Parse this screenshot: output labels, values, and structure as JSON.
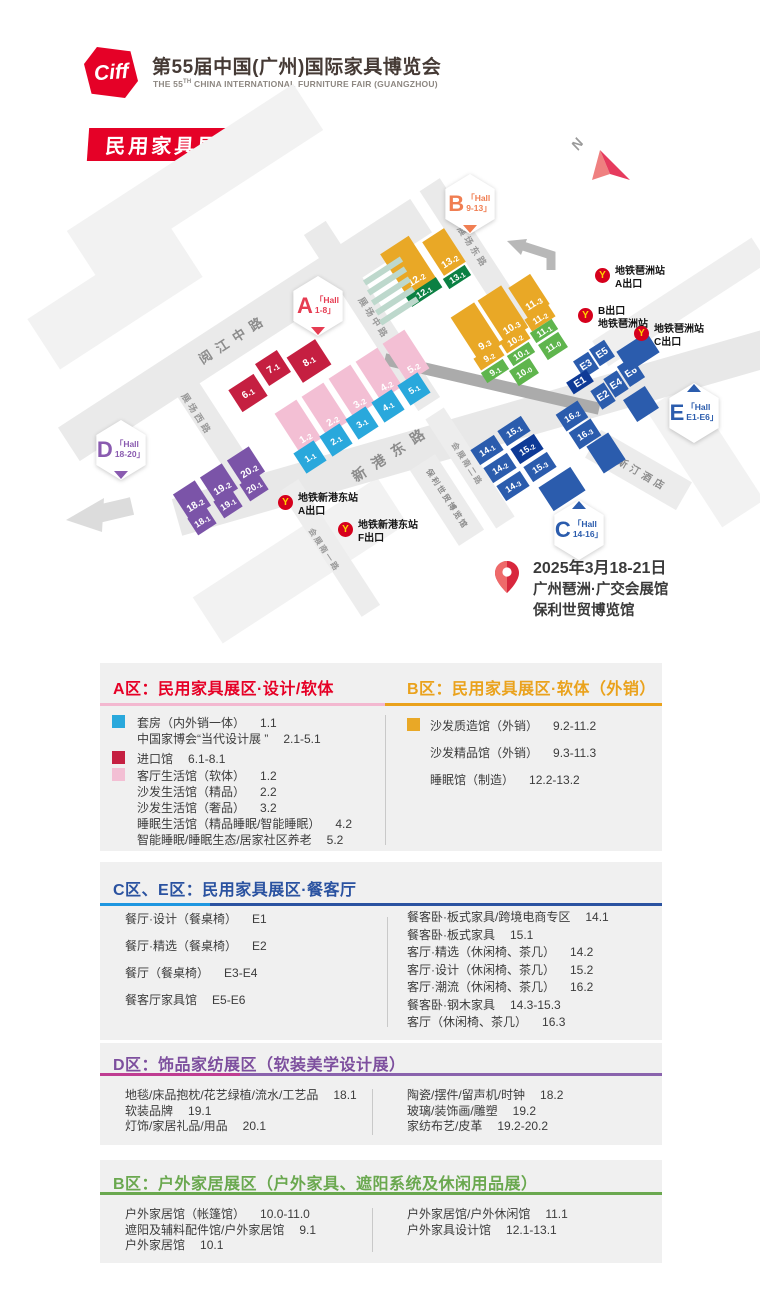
{
  "header": {
    "logo_text": "Ciff",
    "title": "第55届中国(广州)国际家具博览会",
    "subtitle_prefix": "THE 55",
    "subtitle_sup": "TH",
    "subtitle_rest": " CHINA INTERNATIONAL FURNITURE FAIR (GUANGZHOU)",
    "badge": "民用家具展"
  },
  "map": {
    "north_label": "N",
    "date": "2025年3月18-21日",
    "venue1": "广州琶洲·广交会展馆",
    "venue2": "保利世贸博览馆",
    "colors": {
      "red": "#c51f41",
      "pink": "#f3bfd4",
      "blue": "#29a8dc",
      "yellow": "#e9a826",
      "dgreen": "#0b8043",
      "green": "#5fb54d",
      "navy": "#2b5cad",
      "dnavy": "#0e3a96",
      "purple": "#7b54a8",
      "teal": "#bdd8cc"
    },
    "badges": [
      {
        "letter": "B",
        "hall": "Hall",
        "range": "9-13",
        "color": "#f07e52",
        "x": 470,
        "y": 204,
        "pointer": "down"
      },
      {
        "letter": "A",
        "hall": "Hall",
        "range": "1-8",
        "color": "#e63c52",
        "x": 318,
        "y": 306,
        "pointer": "down"
      },
      {
        "letter": "D",
        "hall": "Hall",
        "range": "18-20",
        "color": "#8a5bb0",
        "x": 121,
        "y": 450,
        "pointer": "down"
      },
      {
        "letter": "E",
        "hall": "Hall",
        "range": "E1-E6",
        "color": "#2b5cad",
        "x": 694,
        "y": 413,
        "pointer": "up"
      },
      {
        "letter": "C",
        "hall": "Hall",
        "range": "14-16",
        "color": "#2b5cad",
        "x": 579,
        "y": 530,
        "pointer": "up"
      }
    ],
    "metro": [
      {
        "lines": [
          "地铁琶洲站",
          "A出口"
        ],
        "x": 595,
        "y": 268
      },
      {
        "lines": [
          "B出口",
          "地铁琶洲站"
        ],
        "x": 578,
        "y": 308
      },
      {
        "lines": [
          "地铁琶洲站",
          "C出口"
        ],
        "x": 634,
        "y": 326
      },
      {
        "lines": [
          "地铁新港东站",
          "A出口"
        ],
        "x": 278,
        "y": 495
      },
      {
        "lines": [
          "地铁新港东站",
          "F出口"
        ],
        "x": 338,
        "y": 522
      }
    ],
    "roads": [
      {
        "x": 195,
        "y": 180,
        "w": 270,
        "h": 55,
        "rot": -33,
        "c": "#f2f2f2"
      },
      {
        "x": 115,
        "y": 298,
        "w": 170,
        "h": 60,
        "rot": -33,
        "c": "#f2f2f2"
      },
      {
        "x": 300,
        "y": 560,
        "w": 220,
        "h": 55,
        "rot": -33,
        "c": "#f2f2f2"
      },
      {
        "x": 680,
        "y": 302,
        "w": 190,
        "h": 30,
        "rot": -33,
        "c": "#efefef"
      },
      {
        "x": 705,
        "y": 455,
        "w": 140,
        "h": 50,
        "rot": 57,
        "c": "#f2f2f2"
      },
      {
        "x": 245,
        "y": 330,
        "w": 420,
        "h": 40,
        "rot": -33,
        "c": "#eaeaea"
      },
      {
        "x": 208,
        "y": 420,
        "w": 150,
        "h": 26,
        "rot": 57,
        "c": "#eaeaea"
      },
      {
        "x": 372,
        "y": 316,
        "w": 210,
        "h": 26,
        "rot": 57,
        "c": "#eaeaea"
      },
      {
        "x": 476,
        "y": 256,
        "w": 170,
        "h": 24,
        "rot": 57,
        "c": "#eaeaea"
      },
      {
        "x": 475,
        "y": 432,
        "w": 620,
        "h": 38,
        "rot": -16,
        "c": "#e8e8e8"
      },
      {
        "x": 330,
        "y": 548,
        "w": 150,
        "h": 22,
        "rot": 57,
        "c": "#ededed"
      },
      {
        "x": 470,
        "y": 468,
        "w": 130,
        "h": 22,
        "rot": 57,
        "c": "#ededed"
      },
      {
        "x": 638,
        "y": 470,
        "w": 105,
        "h": 32,
        "rot": 30,
        "c": "#ececec"
      },
      {
        "x": 447,
        "y": 500,
        "w": 90,
        "h": 30,
        "rot": 57,
        "c": "#ececec"
      },
      {
        "x": 492,
        "y": 384,
        "w": 220,
        "h": 12,
        "rot": 13,
        "c": "#ababab"
      }
    ],
    "road_labels": [
      {
        "text": "阅江中路",
        "x": 233,
        "y": 338,
        "rot": -33,
        "fs": 13,
        "ls": 7,
        "c": "#8c8c8c"
      },
      {
        "text": "展场中路",
        "x": 374,
        "y": 318,
        "rot": 57,
        "fs": 9,
        "ls": 3,
        "c": "#9a9a9a"
      },
      {
        "text": "展场东路",
        "x": 473,
        "y": 247,
        "rot": 57,
        "fs": 9,
        "ls": 3,
        "c": "#9a9a9a"
      },
      {
        "text": "展场西路",
        "x": 197,
        "y": 414,
        "rot": 57,
        "fs": 9,
        "ls": 3,
        "c": "#9a9a9a"
      },
      {
        "text": "新港东路",
        "x": 392,
        "y": 453,
        "rot": -33,
        "fs": 14,
        "ls": 9,
        "c": "#8c8c8c"
      },
      {
        "text": "会展南一路",
        "x": 324,
        "y": 550,
        "rot": 57,
        "fs": 8,
        "ls": 2,
        "c": "#9a9a9a"
      },
      {
        "text": "会展南二路",
        "x": 467,
        "y": 464,
        "rot": 57,
        "fs": 8,
        "ls": 2,
        "c": "#9a9a9a"
      },
      {
        "text": "威斯汀酒店",
        "x": 637,
        "y": 470,
        "rot": 30,
        "fs": 10,
        "ls": 4,
        "c": "#8c8c8c"
      },
      {
        "text": "保利世贸博览馆",
        "x": 447,
        "y": 499,
        "rot": 57,
        "fs": 8,
        "ls": 2,
        "c": "#8c8c8c"
      }
    ],
    "blocks": [
      {
        "t": "6.1",
        "x": 248,
        "y": 393,
        "w": 30,
        "h": 26,
        "c": "red"
      },
      {
        "t": "7.1",
        "x": 273,
        "y": 368,
        "w": 26,
        "h": 26,
        "c": "red"
      },
      {
        "t": "8.1",
        "x": 309,
        "y": 361,
        "w": 34,
        "h": 30,
        "c": "red"
      },
      {
        "t": "1.2",
        "x": 298,
        "y": 426,
        "w": 26,
        "h": 46,
        "c": "pink",
        "a": "end"
      },
      {
        "t": "2.2",
        "x": 325,
        "y": 409,
        "w": 26,
        "h": 46,
        "c": "pink",
        "a": "end"
      },
      {
        "t": "3.2",
        "x": 352,
        "y": 391,
        "w": 26,
        "h": 46,
        "c": "pink",
        "a": "end"
      },
      {
        "t": "4.2",
        "x": 379,
        "y": 374,
        "w": 26,
        "h": 46,
        "c": "pink",
        "a": "end"
      },
      {
        "t": "5.2",
        "x": 406,
        "y": 356,
        "w": 26,
        "h": 46,
        "c": "pink",
        "a": "end"
      },
      {
        "t": "1.1",
        "x": 310,
        "y": 457,
        "w": 24,
        "h": 24,
        "c": "blue",
        "fs": 9
      },
      {
        "t": "2.1",
        "x": 336,
        "y": 440,
        "w": 24,
        "h": 24,
        "c": "blue",
        "fs": 9
      },
      {
        "t": "3.1",
        "x": 362,
        "y": 423,
        "w": 24,
        "h": 24,
        "c": "blue",
        "fs": 9
      },
      {
        "t": "4.1",
        "x": 388,
        "y": 406,
        "w": 24,
        "h": 24,
        "c": "blue",
        "fs": 9
      },
      {
        "t": "5.1",
        "x": 414,
        "y": 389,
        "w": 24,
        "h": 24,
        "c": "blue",
        "fs": 9
      },
      {
        "t": "18.2",
        "x": 192,
        "y": 500,
        "w": 26,
        "h": 30,
        "c": "purple",
        "a": "end"
      },
      {
        "t": "19.2",
        "x": 219,
        "y": 483,
        "w": 26,
        "h": 30,
        "c": "purple",
        "a": "end"
      },
      {
        "t": "20.2",
        "x": 246,
        "y": 466,
        "w": 26,
        "h": 30,
        "c": "purple",
        "a": "end"
      },
      {
        "t": "18.1",
        "x": 202,
        "y": 521,
        "w": 22,
        "h": 20,
        "c": "purple",
        "fs": 9
      },
      {
        "t": "19.1",
        "x": 228,
        "y": 504,
        "w": 22,
        "h": 20,
        "c": "purple",
        "fs": 9
      },
      {
        "t": "20.1",
        "x": 254,
        "y": 487,
        "w": 22,
        "h": 20,
        "c": "purple",
        "fs": 9
      },
      {
        "t": "12.2",
        "x": 408,
        "y": 266,
        "w": 34,
        "h": 50,
        "c": "yellow",
        "a": "end"
      },
      {
        "t": "13.2",
        "x": 444,
        "y": 252,
        "w": 26,
        "h": 40,
        "c": "yellow",
        "a": "end"
      },
      {
        "t": "12.1",
        "x": 424,
        "y": 292,
        "w": 36,
        "h": 12,
        "c": "dgreen",
        "fs": 9
      },
      {
        "t": "13.1",
        "x": 457,
        "y": 277,
        "w": 26,
        "h": 12,
        "c": "dgreen",
        "fs": 9
      },
      {
        "t": "9.3",
        "x": 476,
        "y": 331,
        "w": 28,
        "h": 50,
        "c": "yellow",
        "a": "end"
      },
      {
        "t": "10.3",
        "x": 503,
        "y": 314,
        "w": 28,
        "h": 50,
        "c": "yellow",
        "a": "end"
      },
      {
        "t": "11.3",
        "x": 529,
        "y": 296,
        "w": 26,
        "h": 36,
        "c": "yellow",
        "a": "end"
      },
      {
        "t": "9.2",
        "x": 489,
        "y": 357,
        "w": 28,
        "h": 14,
        "c": "yellow",
        "fs": 9
      },
      {
        "t": "10.2",
        "x": 515,
        "y": 340,
        "w": 28,
        "h": 14,
        "c": "yellow",
        "fs": 9
      },
      {
        "t": "11.2",
        "x": 540,
        "y": 318,
        "w": 28,
        "h": 14,
        "c": "yellow",
        "fs": 9
      },
      {
        "t": "9.1",
        "x": 495,
        "y": 371,
        "w": 26,
        "h": 12,
        "c": "green",
        "fs": 9
      },
      {
        "t": "10.1",
        "x": 521,
        "y": 354,
        "w": 26,
        "h": 12,
        "c": "green",
        "fs": 9
      },
      {
        "t": "11.1",
        "x": 544,
        "y": 331,
        "w": 26,
        "h": 12,
        "c": "green",
        "fs": 9
      },
      {
        "t": "10.0",
        "x": 524,
        "y": 372,
        "w": 24,
        "h": 18,
        "c": "green",
        "fs": 9
      },
      {
        "t": "11.0",
        "x": 553,
        "y": 346,
        "w": 24,
        "h": 18,
        "c": "green",
        "fs": 9
      },
      {
        "t": "E3",
        "x": 586,
        "y": 365,
        "w": 18,
        "h": 20,
        "c": "navy"
      },
      {
        "t": "E5",
        "x": 602,
        "y": 353,
        "w": 18,
        "h": 20,
        "c": "navy"
      },
      {
        "t": "E1",
        "x": 580,
        "y": 382,
        "w": 24,
        "h": 14,
        "c": "dnavy"
      },
      {
        "t": "E2",
        "x": 603,
        "y": 396,
        "w": 16,
        "h": 22,
        "c": "navy"
      },
      {
        "t": "E4",
        "x": 616,
        "y": 384,
        "w": 16,
        "h": 22,
        "c": "navy"
      },
      {
        "t": "E6",
        "x": 631,
        "y": 372,
        "w": 18,
        "h": 24,
        "c": "navy"
      },
      {
        "t": "",
        "x": 638,
        "y": 352,
        "w": 36,
        "h": 24,
        "c": "navy"
      },
      {
        "t": "",
        "x": 641,
        "y": 404,
        "w": 26,
        "h": 26,
        "c": "navy"
      },
      {
        "t": "14.1",
        "x": 487,
        "y": 450,
        "w": 28,
        "h": 18,
        "c": "navy",
        "fs": 9
      },
      {
        "t": "15.1",
        "x": 514,
        "y": 431,
        "w": 28,
        "h": 18,
        "c": "navy",
        "fs": 9
      },
      {
        "t": "14.2",
        "x": 500,
        "y": 468,
        "w": 28,
        "h": 18,
        "c": "navy",
        "fs": 9
      },
      {
        "t": "15.2",
        "x": 527,
        "y": 449,
        "w": 28,
        "h": 18,
        "c": "dnavy",
        "fs": 9
      },
      {
        "t": "14.3",
        "x": 513,
        "y": 486,
        "w": 28,
        "h": 18,
        "c": "navy",
        "fs": 9
      },
      {
        "t": "15.3",
        "x": 540,
        "y": 467,
        "w": 28,
        "h": 18,
        "c": "navy",
        "fs": 9
      },
      {
        "t": "16.2",
        "x": 572,
        "y": 416,
        "w": 26,
        "h": 20,
        "c": "navy",
        "fs": 9
      },
      {
        "t": "16.3",
        "x": 585,
        "y": 434,
        "w": 26,
        "h": 20,
        "c": "navy",
        "fs": 9
      },
      {
        "t": "",
        "x": 562,
        "y": 489,
        "w": 38,
        "h": 28,
        "c": "navy"
      },
      {
        "t": "",
        "x": 606,
        "y": 453,
        "w": 26,
        "h": 32,
        "c": "navy"
      },
      {
        "t": "",
        "x": 383,
        "y": 271,
        "w": 44,
        "h": 6,
        "c": "teal"
      },
      {
        "t": "",
        "x": 387,
        "y": 281,
        "w": 44,
        "h": 6,
        "c": "teal"
      },
      {
        "t": "",
        "x": 391,
        "y": 291,
        "w": 44,
        "h": 6,
        "c": "teal"
      },
      {
        "t": "",
        "x": 395,
        "y": 301,
        "w": 44,
        "h": 6,
        "c": "teal"
      },
      {
        "t": "",
        "x": 399,
        "y": 311,
        "w": 44,
        "h": 6,
        "c": "teal"
      }
    ]
  },
  "legend": {
    "sections": {
      "A": {
        "title": "A区：民用家具展区·设计/软体",
        "color": "#e60026",
        "line": "#f3b8d0",
        "items": [
          {
            "sw": "#29a8dc",
            "t": "套房（内外销一体）",
            "n": "1.1"
          },
          {
            "t": "中国家博会“当代设计展 ”",
            "n": "2.1-5.1"
          },
          {
            "sw": "#c51f41",
            "t": "进口馆",
            "n": "6.1-8.1",
            "gap": true
          },
          {
            "sw": "#f3bfd4",
            "t": "客厅生活馆（软体）",
            "n": "1.2"
          },
          {
            "t": "沙发生活馆（精品）",
            "n": "2.2"
          },
          {
            "t": "沙发生活馆（奢品）",
            "n": "3.2"
          },
          {
            "t": "睡眠生活馆（精品睡眠/智能睡眠）",
            "n": "4.2"
          },
          {
            "t": "智能睡眠/睡眠生态/居家社区养老",
            "n": "5.2"
          }
        ]
      },
      "B": {
        "title": "B区：民用家具展区·软体（外销）",
        "color": "#eaa21c",
        "line": "#eaa21c",
        "items": [
          {
            "sw": "#e9a826",
            "t": "沙发质造馆（外销）",
            "n": "9.2-11.2"
          },
          {
            "t": "沙发精品馆（外销）",
            "n": "9.3-11.3"
          },
          {
            "t": "睡眠馆（制造）",
            "n": "12.2-13.2"
          }
        ]
      },
      "CE": {
        "title": "C区、E区：民用家具展区·餐客厅",
        "color": "#2a52a0",
        "line": "#2a52a0",
        "accent": "#1e96e0",
        "items_left": [
          {
            "t": "餐厅·设计（餐桌椅）",
            "n": "E1"
          },
          {
            "t": "餐厅·精选（餐桌椅）",
            "n": "E2"
          },
          {
            "t": "餐厅（餐桌椅）",
            "n": "E3-E4"
          },
          {
            "t": "餐客厅家具馆",
            "n": "E5-E6"
          }
        ],
        "items_right": [
          {
            "t": "餐客卧·板式家具/跨境电商专区",
            "n": "14.1"
          },
          {
            "t": "餐客卧·板式家具",
            "n": "15.1"
          },
          {
            "t": "客厅·精选（休闲椅、茶几）",
            "n": "14.2"
          },
          {
            "t": "客厅·设计（休闲椅、茶几）",
            "n": "15.2"
          },
          {
            "t": "客厅·潮流（休闲椅、茶几）",
            "n": "16.2"
          },
          {
            "t": "餐客卧·钢木家具",
            "n": "14.3-15.3"
          },
          {
            "t": "客厅（休闲椅、茶几）",
            "n": "16.3"
          }
        ]
      },
      "D": {
        "title": "D区：饰品家纺展区（软装美学设计展）",
        "color": "#7d4f9e",
        "line": "#8a63ad",
        "accent": "#bf3d92",
        "items_left": [
          {
            "t": "地毯/床品抱枕/花艺绿植/流水/工艺品",
            "n": "18.1"
          },
          {
            "t": "软装品牌",
            "n": "19.1"
          },
          {
            "t": "灯饰/家居礼品/用品",
            "n": "20.1"
          }
        ],
        "items_right": [
          {
            "t": "陶瓷/摆件/留声机/时钟",
            "n": "18.2"
          },
          {
            "t": "玻璃/装饰画/雕塑",
            "n": "19.2"
          },
          {
            "t": "家纺布艺/皮革",
            "n": "19.2-20.2"
          }
        ]
      },
      "G": {
        "title": "B区：户外家居展区（户外家具、遮阳系统及休闲用品展）",
        "color": "#6aa84f",
        "line": "#6aa84f",
        "items_left": [
          {
            "t": "户外家居馆（帐篷馆）",
            "n": "10.0-11.0"
          },
          {
            "t": "遮阳及辅料配件馆/户外家居馆",
            "n": "9.1"
          },
          {
            "t": "户外家居馆",
            "n": "10.1"
          }
        ],
        "items_right": [
          {
            "t": "户外家居馆/户外休闲馆",
            "n": "11.1"
          },
          {
            "t": "户外家具设计馆",
            "n": "12.1-13.1"
          }
        ]
      }
    }
  }
}
